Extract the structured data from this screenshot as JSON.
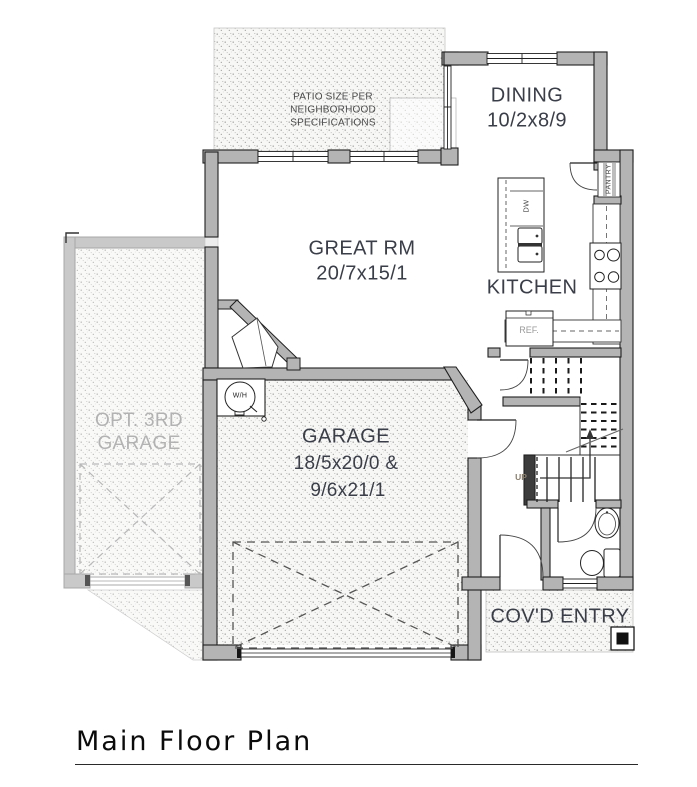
{
  "document": {
    "title": "Main Floor Plan"
  },
  "rooms": {
    "dining": {
      "name": "DINING",
      "dims": "10/2x8/9"
    },
    "great_room": {
      "name": "GREAT RM",
      "dims": "20/7x15/1"
    },
    "kitchen": {
      "name": "KITCHEN"
    },
    "garage": {
      "name": "GARAGE",
      "dims_line1": "18/5x20/0 &",
      "dims_line2": "9/6x21/1"
    },
    "opt_garage": {
      "name_line1": "OPT. 3RD",
      "name_line2": "GARAGE"
    },
    "covd_entry": {
      "name": "COV'D ENTRY"
    }
  },
  "annotations": {
    "patio_note": {
      "line1": "PATIO SIZE PER",
      "line2": "NEIGHBORHOOD",
      "line3": "SPECIFICATIONS"
    },
    "pantry": "PANTRY",
    "refrigerator": "REF.",
    "dishwasher": "DW",
    "stairs_direction": "UP",
    "water_heater": "W/H"
  },
  "colors": {
    "paper": "#ffffff",
    "wall_fill": "#b4b4b4",
    "wall_outline": "#1f1f1f",
    "optional_structure": "#c9c9c9",
    "label_text": "#3a3e49",
    "muted_label_text": "#b2b2b2",
    "stipple_dot": "#8e8e8e"
  }
}
